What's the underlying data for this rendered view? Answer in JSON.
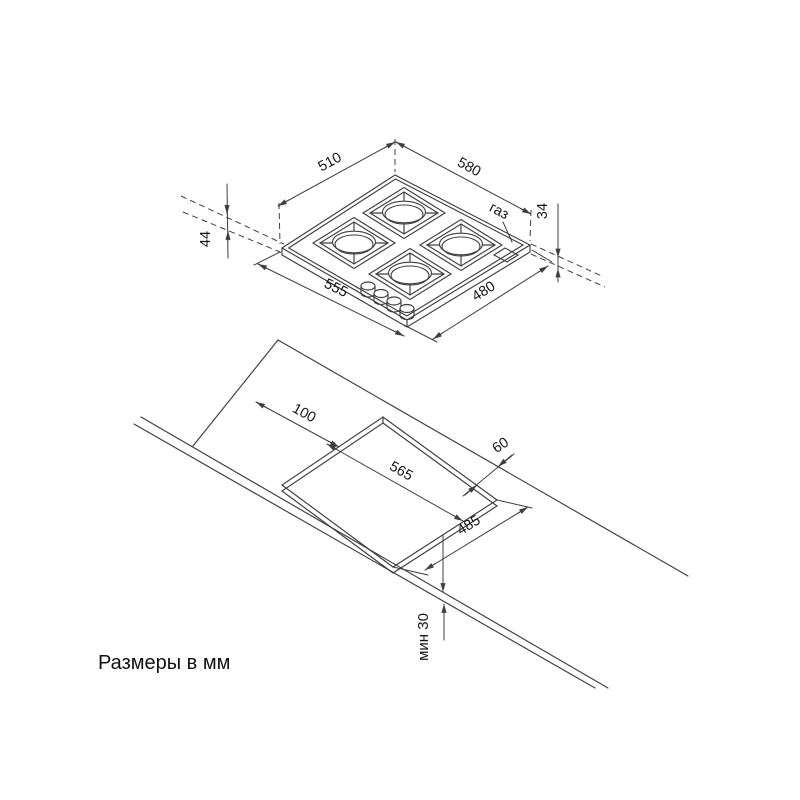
{
  "page": {
    "footnote": "Размеры в мм"
  },
  "hob_view": {
    "labels": {
      "top_left_width": "510",
      "top_right_width": "580",
      "left_height": "44",
      "right_height": "34",
      "bottom_left_width": "555",
      "bottom_right_width": "480",
      "gas": "газ"
    }
  },
  "cutout_view": {
    "labels": {
      "left_offset": "100",
      "back_offset": "60",
      "width": "565",
      "depth": "485",
      "front_min_clearance": "мин 30"
    }
  }
}
